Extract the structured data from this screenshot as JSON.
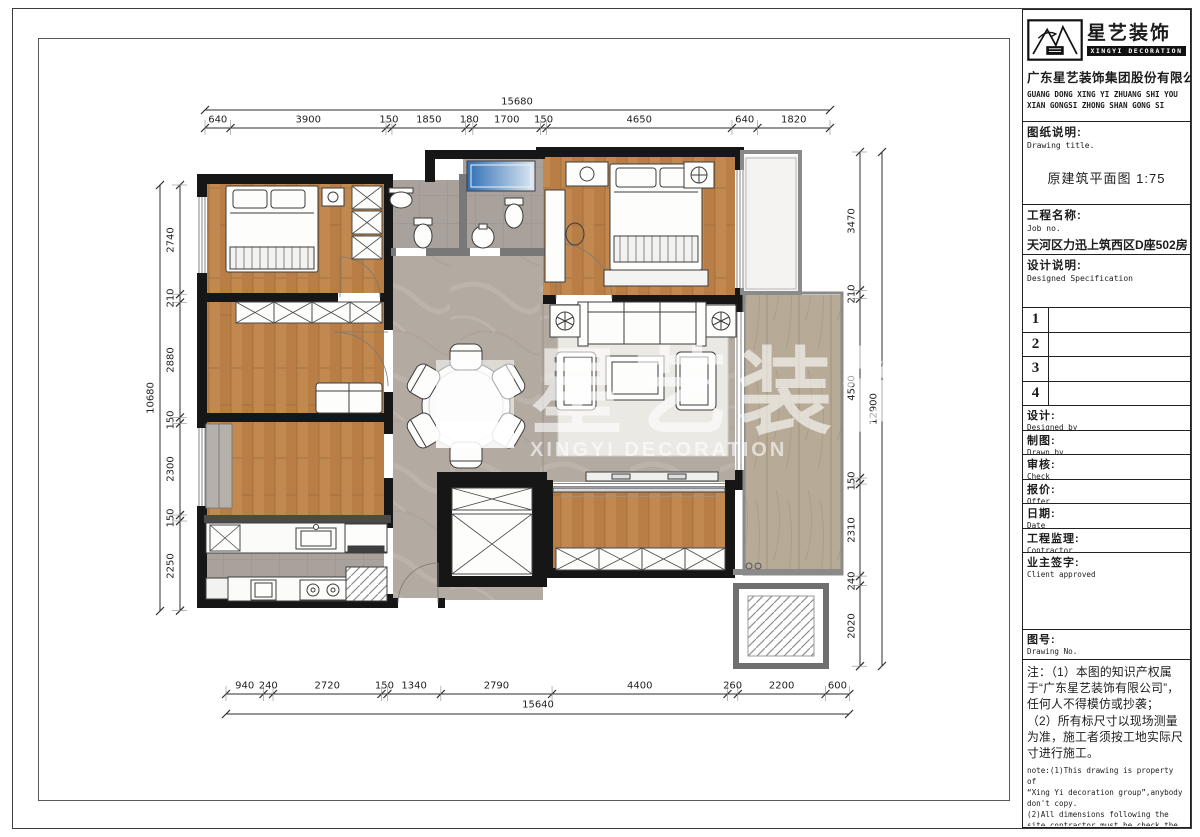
{
  "title_block": {
    "logo": {
      "brand_cn": "星艺装饰",
      "brand_en": "XINGYI DECORATION",
      "logo_icon": "mountain-bird-logo"
    },
    "company_cn": "广东星艺装饰集团股份有限公司",
    "company_en_line1": "GUANG DONG XING YI ZHUANG SHI YOU",
    "company_en_line2": "XIAN GONGSI ZHONG SHAN GONG SI",
    "drawing_title_label_cn": "图纸说明:",
    "drawing_title_label_en": "Drawing title.",
    "drawing_title_value": "原建筑平面图 1:75",
    "job_label_cn": "工程名称:",
    "job_label_en": "Job  no.",
    "job_value": "天河区力迅上筑西区D座502房",
    "design_spec_label_cn": "设计说明:",
    "design_spec_label_en": "Designed Specification",
    "revision_rows": [
      "1",
      "2",
      "3",
      "4"
    ],
    "fields": [
      {
        "cn": "设计:",
        "en": "Designed by"
      },
      {
        "cn": "制图:",
        "en": "Drawn by"
      },
      {
        "cn": "审核:",
        "en": "Check"
      },
      {
        "cn": "报价:",
        "en": "Offer"
      },
      {
        "cn": "日期:",
        "en": "Date"
      },
      {
        "cn": "工程监理:",
        "en": "Contractor"
      },
      {
        "cn": "业主签字:",
        "en": "Client approved"
      }
    ],
    "drawing_no_label_cn": "图号:",
    "drawing_no_label_en": "Drawing No.",
    "note_cn": "注：（1）本图的知识产权属\n于“广东星艺装饰有限公司”，\n任何人不得模仿或抄袭；\n（2）所有标尺寸以现场测量\n为准，施工者须按工地实际尺\n寸进行施工。",
    "note_en": "note:(1)This drawing is property of\n“Xing Yi decoration group”,anybody\ndon't copy.\n(2)All dimensions following the\nsite,contractor must be check the\nmersurement."
  },
  "plan": {
    "watermark": {
      "text_cn": "星艺装饰",
      "text_en": "XINGYI DECORATION"
    },
    "dimensions": {
      "top_total": "15680",
      "top": [
        "640",
        "3900",
        "150",
        "1850",
        "180",
        "1700",
        "150",
        "4650",
        "640",
        "1820"
      ],
      "bottom_total": "15640",
      "bottom": [
        "940",
        "240",
        "2720",
        "150",
        "1340",
        "2790",
        "4400",
        "260",
        "2200",
        "600"
      ],
      "left_total": "10680",
      "left": [
        "2740",
        "210",
        "2880",
        "150",
        "2300",
        "150",
        "2250"
      ],
      "right_total": "12900",
      "right": [
        "3470",
        "210",
        "4500",
        "150",
        "2310",
        "240",
        "2020"
      ]
    }
  }
}
